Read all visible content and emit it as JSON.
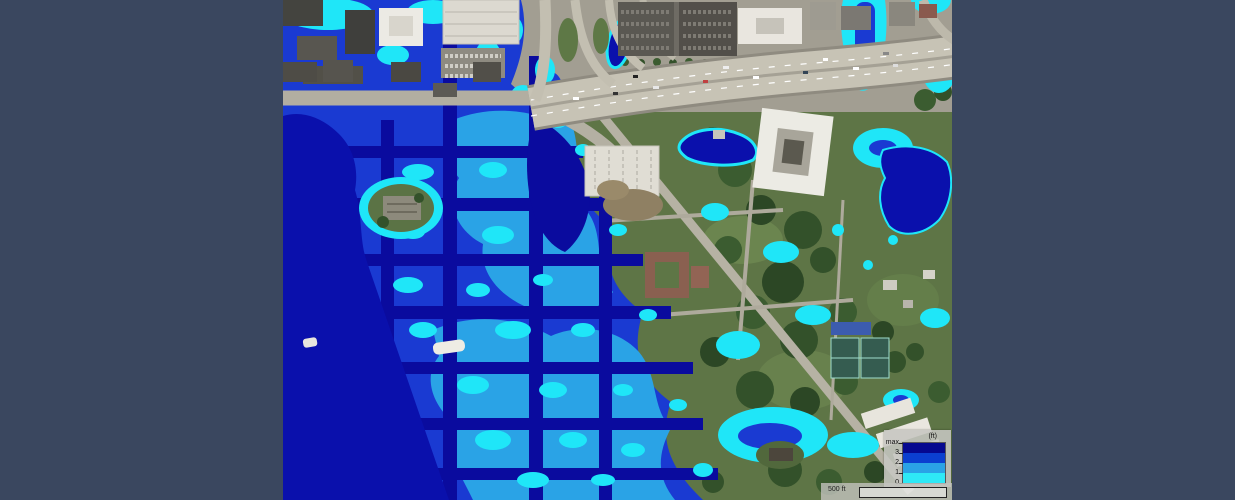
{
  "frame": {
    "background": "#3a475f"
  },
  "map": {
    "kind": "flood-depth-inundation-overlay-on-aerial-imagery",
    "legend": {
      "title": "(ft)",
      "ticks": [
        "max",
        "3",
        "2",
        "1",
        "0"
      ],
      "bands": [
        {
          "color": "#05088f"
        },
        {
          "color": "#0b3fd0"
        },
        {
          "color": "#2aa3e6"
        },
        {
          "color": "#2ee9f6"
        }
      ]
    },
    "scale_bar": {
      "label": "500 ft"
    }
  },
  "colors": {
    "frame_bg": "#3a475f",
    "flood_deep": "#0a0b9e",
    "flood_mid": "#1a3ad2",
    "flood_low": "#2aa3e6",
    "flood_shallow": "#1fe6f8",
    "water_body": "#0a10ac",
    "road": "#c7c3b5",
    "vegetation": "#5e7546",
    "urban": "#a29e92"
  }
}
